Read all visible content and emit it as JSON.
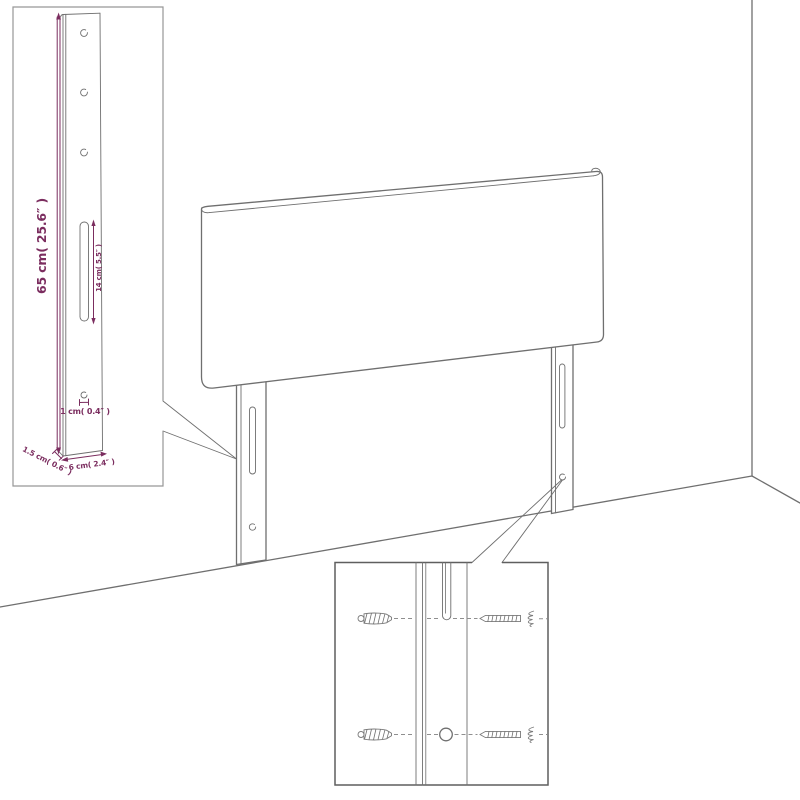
{
  "diagram": {
    "kind": "headboard assembly dimension drawing",
    "colors": {
      "line_gray": "#6f6f6f",
      "inset_border_light": "#979797",
      "inset_border_dark": "#5f5f5f",
      "dimension_purple": "#7b2d5f",
      "background": "#ffffff"
    },
    "leg_inset": {
      "height_label": "65 cm( 25.6″ )",
      "slot_label": "14 cm( 5.5″ )",
      "hole_label": "1 cm( 0.4″ )",
      "side_label": "1.5 cm( 0.6″ )",
      "width_label": "6 cm( 2.4″ )"
    }
  }
}
